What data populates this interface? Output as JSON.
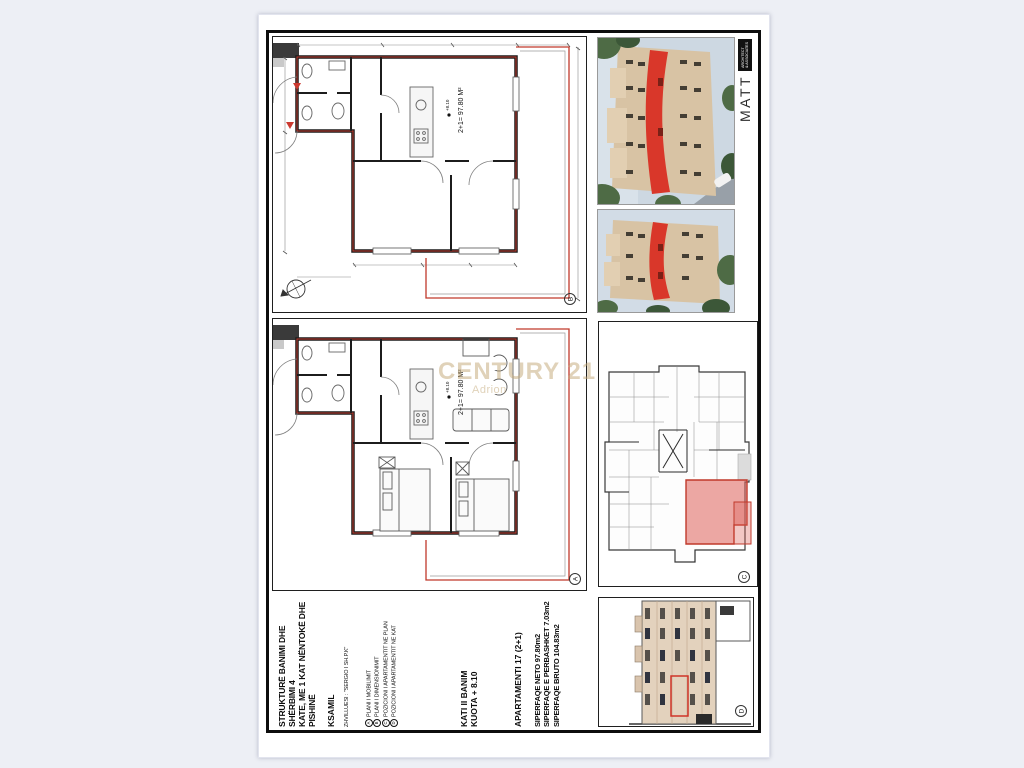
{
  "title_block": {
    "title_line1": "STRUKTURË BANIMI DHE SHËRBIMI 4",
    "title_line2": "KATE, ME 1 KAT NËNTOKË DHE",
    "title_line3": "PISHINË",
    "city": "KSAMIL",
    "developer": "ZHVILLUESI : \"SERGIO I SH.P.K\"",
    "legend": [
      {
        "marker": "A",
        "label": "PLANI I MOBILIMIT"
      },
      {
        "marker": "B",
        "label": "PLANI I DIMENSIONIMIT"
      },
      {
        "marker": "C",
        "label": "POZICIONI I APARTAMENTIT NE PLAN"
      },
      {
        "marker": "D",
        "label": "POZICIONI I APARTAMENTIT NE KAT"
      }
    ],
    "floor": "KATI II BANIM",
    "elevation": "KUOTA + 8.10",
    "apartment": "APARTAMENTI 17 (2+1)",
    "area_net": "SIPERFAQE NETO  97.80m2",
    "area_common": "SIPERFAQE E PERBASHKET  7.03m2",
    "area_gross": "SIPERFAQE BRUTO  104.83m2"
  },
  "plans": {
    "area_label": "2+1= 97.80 M²",
    "level_label": "+8.10",
    "marker_a": "A",
    "marker_b": "B",
    "marker_c": "C",
    "marker_d": "D"
  },
  "logo": {
    "name": "MATT",
    "badge_line1": "ARCHITECT",
    "badge_line2": "& ASSOCIATES"
  },
  "watermark": {
    "brand": "CENTURY 21",
    "sub": "Adrion"
  },
  "colors": {
    "highlight_red": "#d9372a",
    "plan_boundary_red": "#c0392b",
    "apartment_fill_red": "#e98b86",
    "facade_tan": "#d8c3a4",
    "watermark_gold": "#c1a673"
  }
}
